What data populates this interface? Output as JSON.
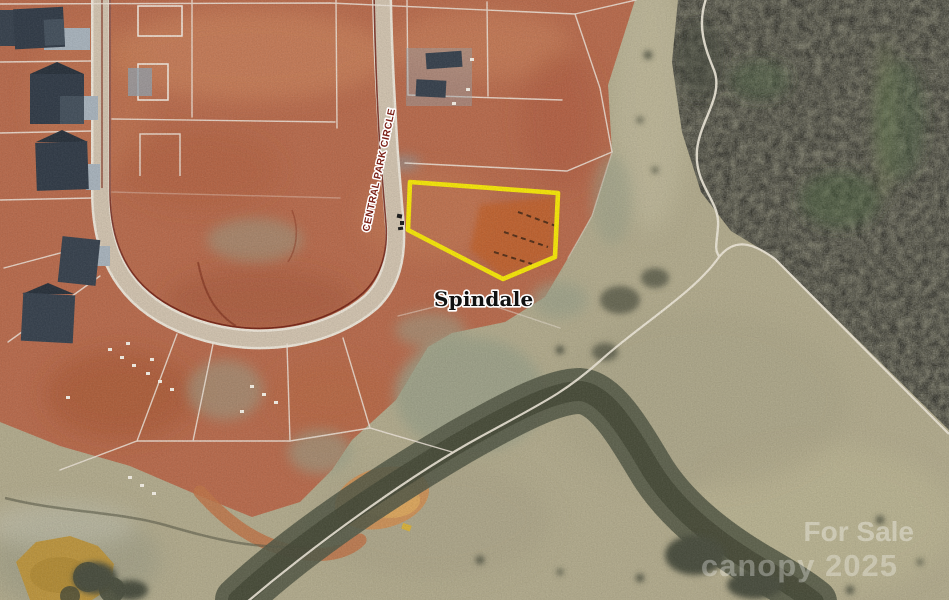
{
  "map": {
    "street_label": "CENTRAL PARK CIRCLE",
    "place_label": "Spindale",
    "parcel": {
      "outline_points": "410,182 558,193 555,257 503,279 408,230",
      "outline_color": "#f6e70a"
    },
    "colors": {
      "clay_soil": "#b96c4e",
      "forest": "#6f6e5d",
      "field_grass": "#b3ac8e",
      "road_surface": "#d2c4b0",
      "road_curb": "#6e1d12",
      "pond_water": "#bd9640",
      "lot_line": "#efe6db",
      "house_roof": "#333d49",
      "street_label_text": "#7a1f15",
      "place_label_text": "#111111",
      "watermark_text": "#ffffff"
    }
  },
  "watermark": {
    "line1": "For Sale",
    "line2": "canopy 2025"
  }
}
